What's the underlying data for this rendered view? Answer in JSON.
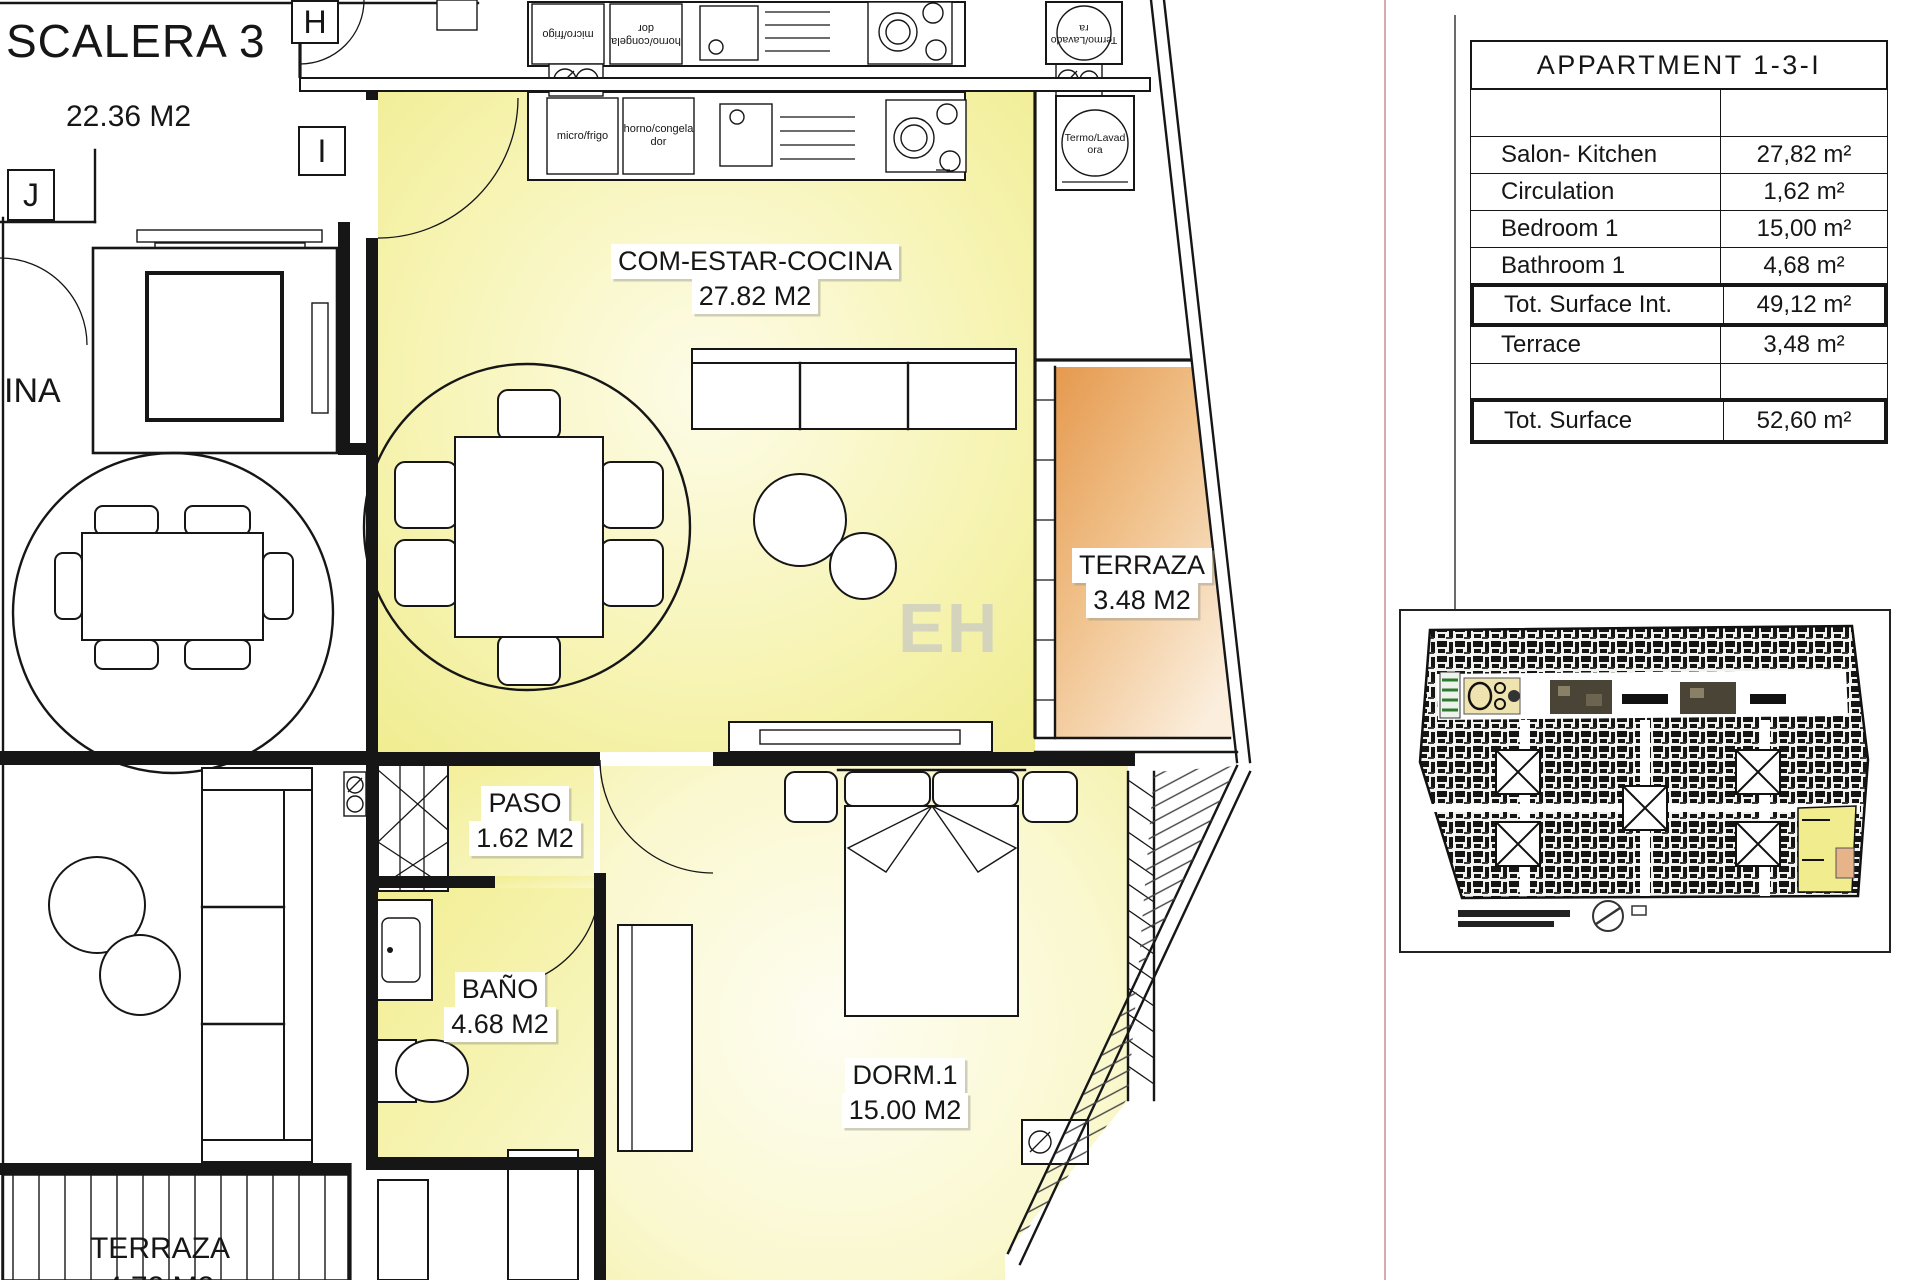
{
  "plan": {
    "stair": {
      "label": "SCALERA 3",
      "area": "22.36 M2"
    },
    "grid_letters": {
      "h": "H",
      "i": "I",
      "j": "J"
    },
    "neighbor_label": "INA",
    "rooms": {
      "living": {
        "name": "COM-ESTAR-COCINA",
        "area": "27.82 M2"
      },
      "terrace": {
        "name": "TERRAZA",
        "area": "3.48 M2"
      },
      "hall": {
        "name": "PASO",
        "area": "1.62 M2"
      },
      "bath": {
        "name": "BAÑO",
        "area": "4.68 M2"
      },
      "bedroom": {
        "name": "DORM.1",
        "area": "15.00 M2"
      },
      "neighbor_terrace": {
        "name": "TERRAZA",
        "area": "4.72 M2"
      }
    },
    "appliances": {
      "micro_fridge": "micro/frigo",
      "oven_freezer": "horno/congelador",
      "boiler_washer": "Termo/Lavadora"
    },
    "watermark": "EH"
  },
  "summary_table": {
    "title": "APPARTMENT 1-3-I",
    "rows": [
      {
        "label": "",
        "value": ""
      },
      {
        "label": "Salon- Kitchen",
        "value": "27,82 m²"
      },
      {
        "label": "Circulation",
        "value": "1,62 m²"
      },
      {
        "label": "Bedroom 1",
        "value": "15,00 m²"
      },
      {
        "label": "Bathroom 1",
        "value": "4,68 m²"
      },
      {
        "label": "Tot. Surface Int.",
        "value": "49,12 m²"
      },
      {
        "label": "Terrace",
        "value": "3,48 m²"
      },
      {
        "label": "",
        "value": ""
      },
      {
        "label": "Tot. Surface",
        "value": "52,60 m²"
      }
    ]
  },
  "colors": {
    "room_yellow": "#f2ee8f",
    "room_yellow_light": "#fdfce8",
    "terrace_orange": "#e5994e",
    "terrace_orange_light": "#fbeedd",
    "line": "#161616"
  }
}
